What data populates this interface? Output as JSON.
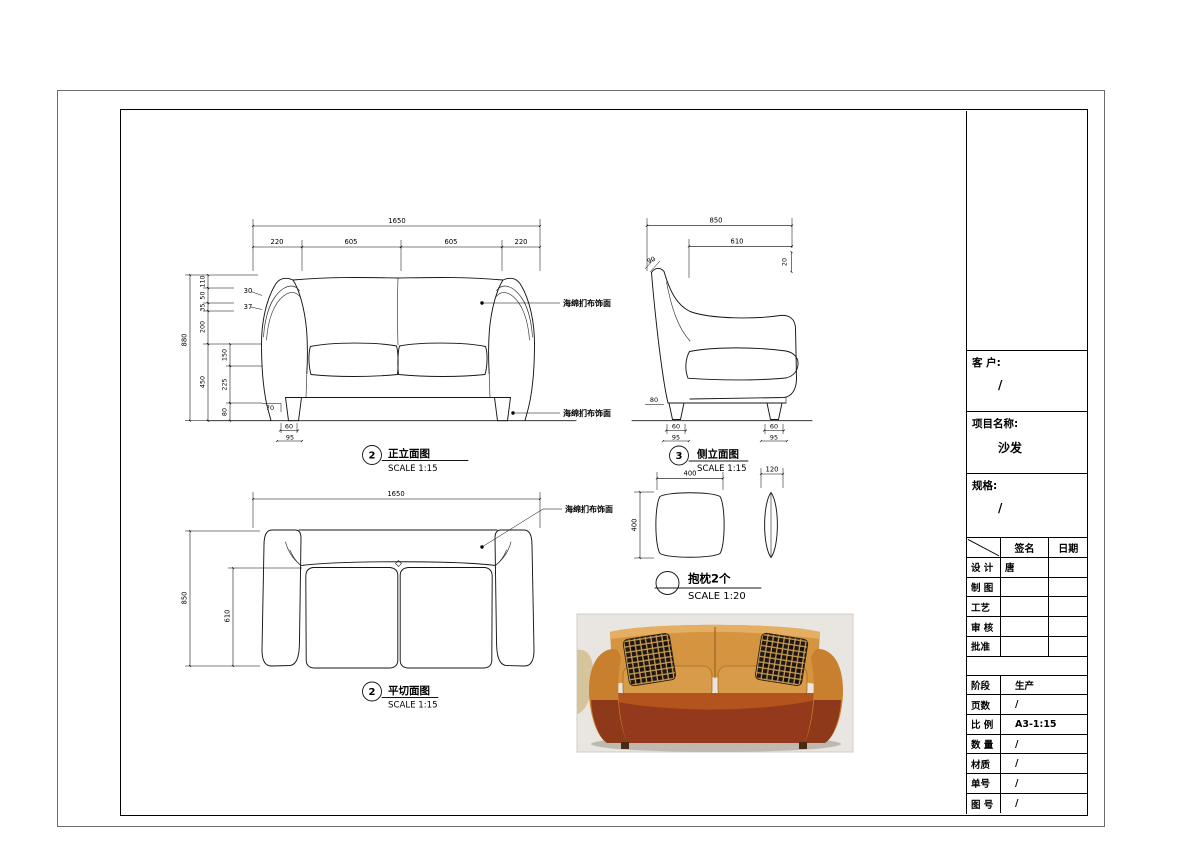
{
  "views": {
    "front": {
      "num": "2",
      "name": "正立面图",
      "scale": "SCALE 1:15",
      "callout_top": "海绵扪布饰面",
      "callout_bottom": "海绵扪布饰面",
      "dims": {
        "total_w": "1650",
        "seg1": "220",
        "seg2": "605",
        "seg3": "605",
        "seg4": "220",
        "total_h": "880",
        "h1": "110",
        "h2": "50",
        "h3": "35",
        "h4": "200",
        "h5": "450",
        "i1": "150",
        "i2": "225",
        "i3": "80",
        "d30": "30",
        "d37": "37",
        "d70": "70",
        "leg_w": "60",
        "leg_base": "95"
      }
    },
    "side": {
      "num": "3",
      "name": "侧立面图",
      "scale": "SCALE 1:15",
      "dims": {
        "total_d": "850",
        "inner_d": "610",
        "d20": "20",
        "d90": "90",
        "d80": "80",
        "leg_w": "60",
        "leg_base": "95"
      }
    },
    "plan": {
      "num": "2",
      "name": "平切面图",
      "scale": "SCALE 1:15",
      "callout": "海绵扪布饰面",
      "dims": {
        "total_w": "1650",
        "total_d": "850",
        "inner_d": "610"
      }
    },
    "pillow": {
      "name": "抱枕2个",
      "scale": "SCALE 1:20",
      "dims": {
        "w": "400",
        "h": "400",
        "t": "120"
      }
    }
  },
  "title_block": {
    "client_label": "客 户:",
    "client_value": "/",
    "project_label": "项目名称:",
    "project_value": "沙发",
    "spec_label": "规格:",
    "spec_value": "/",
    "sign_header": {
      "signature": "签名",
      "date": "日期"
    },
    "sign_rows": [
      {
        "label": "设 计",
        "signature": "唐",
        "date": ""
      },
      {
        "label": "制 图",
        "signature": "",
        "date": ""
      },
      {
        "label": "工艺",
        "signature": "",
        "date": ""
      },
      {
        "label": "审 核",
        "signature": "",
        "date": ""
      },
      {
        "label": "批准",
        "signature": "",
        "date": ""
      }
    ],
    "info_rows": [
      {
        "label": "阶段",
        "value": "生产"
      },
      {
        "label": "页数",
        "value": "/"
      },
      {
        "label": "比 例",
        "value": "A3-1:15"
      },
      {
        "label": "数 量",
        "value": "/"
      },
      {
        "label": "材质",
        "value": "/"
      },
      {
        "label": "单号",
        "value": "/"
      },
      {
        "label": "图 号",
        "value": "/"
      }
    ]
  }
}
